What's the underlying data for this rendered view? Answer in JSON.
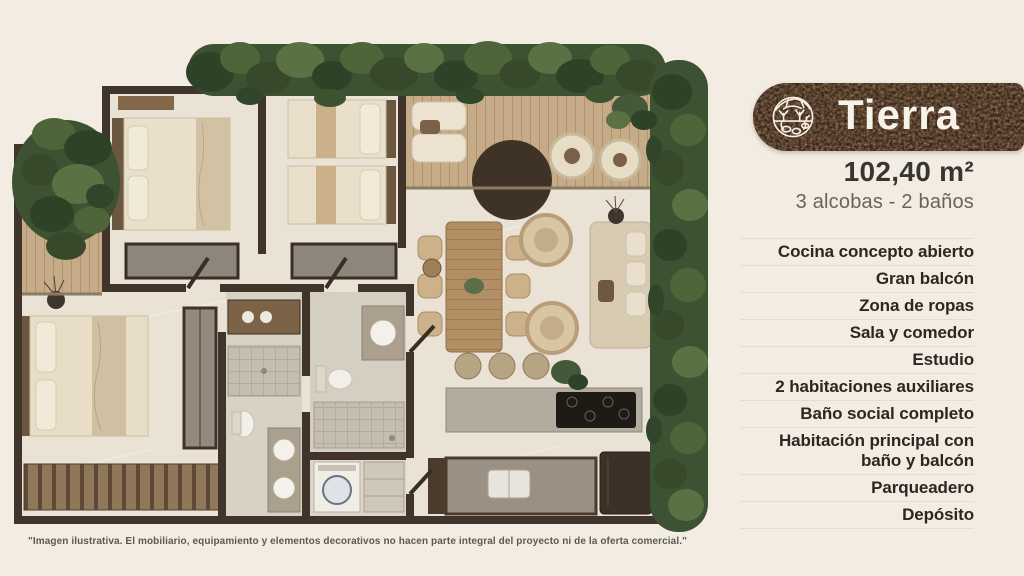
{
  "badge": {
    "title": "Tierra",
    "icon": "soil-earth-icon"
  },
  "unit": {
    "area": "102,40 m²",
    "rooms_line": "3 alcobas - 2 baños"
  },
  "features": {
    "items": [
      "Cocina concepto abierto",
      "Gran balcón",
      "Zona de ropas",
      "Sala y comedor",
      "Estudio",
      "2 habitaciones auxiliares",
      "Baño social completo",
      "Habitación principal con baño y balcón",
      "Parqueadero",
      "Depósito"
    ]
  },
  "disclaimer": "\"Imagen ilustrativa. El mobiliario, equipamiento y elementos decorativos no hacen parte integral del proyecto ni de la oferta comercial.\"",
  "palette": {
    "background": "#f2ece2",
    "badge_bg": "#2a1a11",
    "badge_rust": "#8a4a28",
    "badge_text": "#f7f2e9",
    "area_text": "#383531",
    "subtitle_text": "#68645b",
    "feature_text": "#2b2822",
    "wall": "#41342a",
    "greenery": "#3c5232",
    "deck_wood": "#c6ab88",
    "floor": "#eae2d5"
  }
}
